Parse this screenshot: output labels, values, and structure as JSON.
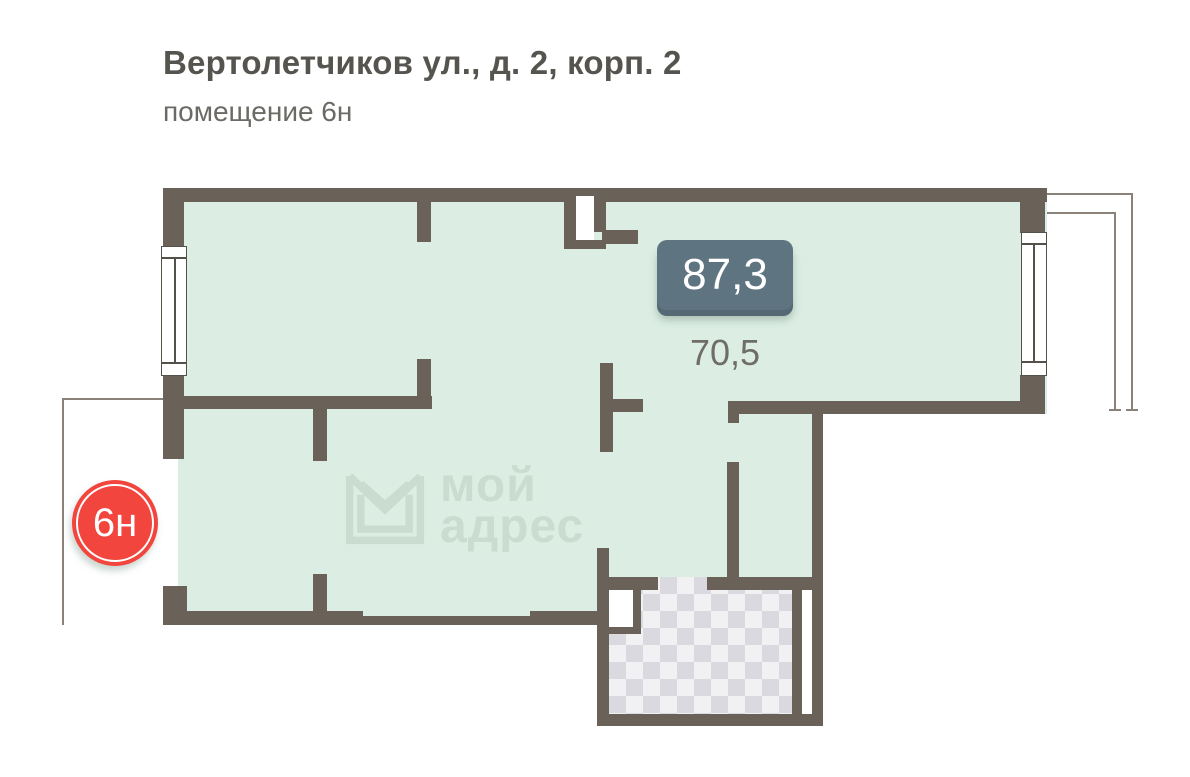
{
  "header": {
    "title": "Вертолетчиков ул., д. 2, корп. 2",
    "subtitle": "помещение 6н"
  },
  "plan": {
    "area_badge_value": "87,3",
    "area_secondary_value": "70,5",
    "unit_badge_label": "6н",
    "watermark": {
      "line1": "мой",
      "line2": "адрес",
      "logo_icon": "envelope-m-logo"
    }
  },
  "colors": {
    "wall": "#6a6158",
    "room_fill": "#dceee4",
    "thin_line": "#8a8279",
    "area_badge_bg": "#5e7481",
    "unit_badge_bg": "#f2453d",
    "watermark": "#c9dccf",
    "tile_light": "#f1f1f4",
    "tile_dark": "#d9d9df"
  }
}
